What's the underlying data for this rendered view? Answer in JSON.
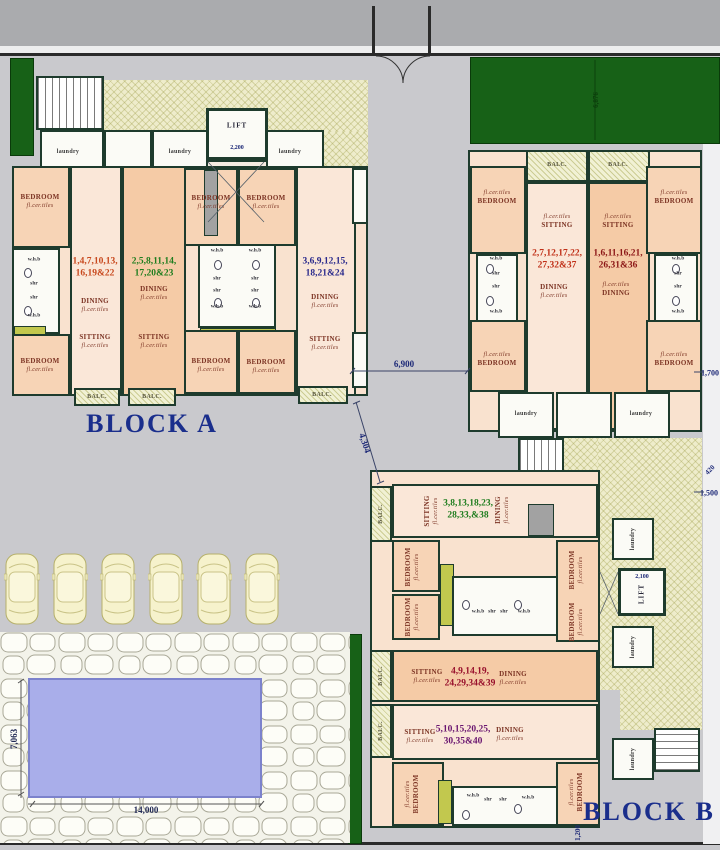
{
  "labels": {
    "bedroom": "BEDROOM",
    "sitting": "SITTING",
    "dining": "DINING",
    "laundry": "laundry",
    "balc": "BALC.",
    "lift": "LIFT",
    "tiles": "fl.cer.tiles",
    "whb": "w.h.b",
    "shr": "shr"
  },
  "titles": {
    "block_a": "BLOCK A",
    "block_b": "BLOCK B"
  },
  "units": {
    "a1": {
      "line1": "1,4,7,10,13,",
      "line2": "16,19&22",
      "color": "#c8491e"
    },
    "a2": {
      "line1": "2,5,8,11,14,",
      "line2": "17,20&23",
      "color": "#1e7d1e"
    },
    "a3": {
      "line1": "3,6,9,12,15,",
      "line2": "18,21&24",
      "color": "#2a2a8c"
    },
    "b1": {
      "line1": "2,7,12,17,22,",
      "line2": "27,32&37",
      "color": "#c03018"
    },
    "b2": {
      "line1": "1,6,11,16,21,",
      "line2": "26,31&36",
      "color": "#8c1616"
    },
    "b3": {
      "line1": "3,8,13,18,23,",
      "line2": "28,33,&38",
      "color": "#1e7d1e"
    },
    "b4": {
      "line1": "4,9,14,19,",
      "line2": "24,29,34&39",
      "color": "#98102c"
    },
    "b5": {
      "line1": "5,10,15,20,25,",
      "line2": "30,35&40",
      "color": "#6a1670"
    }
  },
  "dims": {
    "d6900": "6,900",
    "d4304": "4,304",
    "d1700": "1,700",
    "d1500": "1,500",
    "d420": "420",
    "d2200": "2,200",
    "d2100": "2,100",
    "d1200": "1,200",
    "d7063": "7,063",
    "d14000": "14,000",
    "d6876": "6,876"
  },
  "colors": {
    "wall": "#1e3b2d",
    "lawn_green": "#176117",
    "pool_blue": "#a9aeea",
    "title_navy": "#1a2e8c",
    "room_peach": "#f5cba6",
    "corridor_khaki": "#eeeccb"
  }
}
